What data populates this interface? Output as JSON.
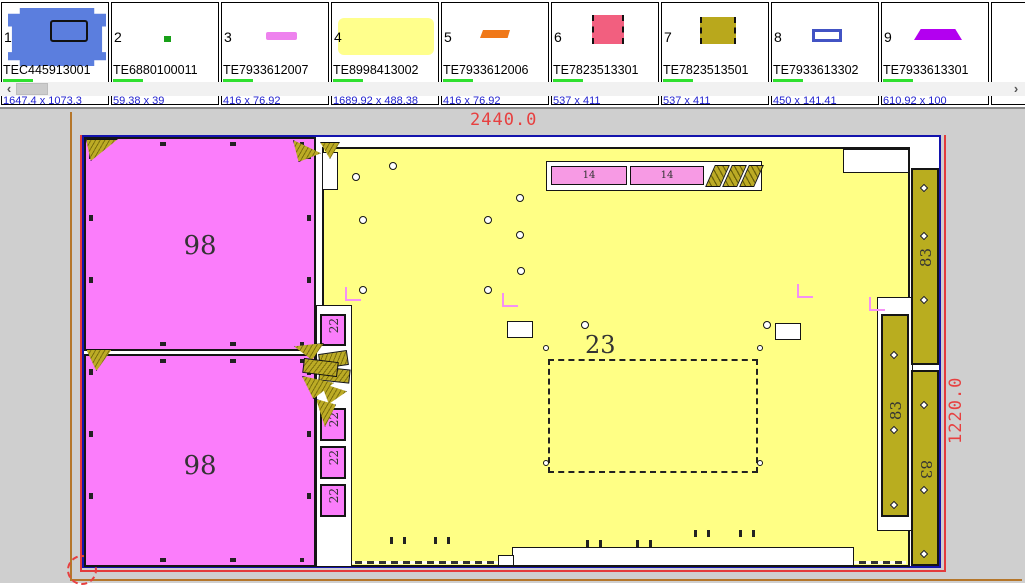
{
  "parts_strip": {
    "cells": [
      {
        "index": "1",
        "code": "TEC445913001",
        "dims": "1647.4 x 1073.3",
        "color": "#5b7ede",
        "shape": "panel-with-cutout"
      },
      {
        "index": "2",
        "code": "TE6880100011",
        "dims": "59.38 x 39",
        "color": "#18a018",
        "shape": "tiny-block"
      },
      {
        "index": "3",
        "code": "TE7933612007",
        "dims": "416 x 76.92",
        "color": "#ee82ee",
        "shape": "thin-bar"
      },
      {
        "index": "4",
        "code": "TE8998413002",
        "dims": "1689.92 x 488.38",
        "color": "#ffff8c",
        "shape": "large-panel"
      },
      {
        "index": "5",
        "code": "TE7933612006",
        "dims": "416 x 76.92",
        "color": "#f07818",
        "shape": "thin-bar"
      },
      {
        "index": "6",
        "code": "TE7823513301",
        "dims": "537 x 411",
        "color": "#f25f7f",
        "shape": "rect-dashed-sides"
      },
      {
        "index": "7",
        "code": "TE7823513501",
        "dims": "537 x 411",
        "color": "#b9a81c",
        "shape": "rect-dashed-sides"
      },
      {
        "index": "8",
        "code": "TE7933613302",
        "dims": "450 x 141.41",
        "color": "#4253c4",
        "shape": "flat-frame"
      },
      {
        "index": "9",
        "code": "TE7933613301",
        "dims": "610.92 x 100",
        "color": "#b300f0",
        "shape": "trapezoid"
      }
    ],
    "scrollbar": {
      "left_arrow": "‹",
      "right_arrow": "›"
    }
  },
  "canvas": {
    "sheet": {
      "width_label": "2440.0",
      "height_label": "1220.0"
    },
    "parts": {
      "panel_top": "98",
      "panel_bottom": "98",
      "back_panel": "23",
      "shelves": [
        "14",
        "14"
      ],
      "rails": [
        "22",
        "22",
        "22",
        "22"
      ],
      "strips": [
        "83",
        "83",
        "83"
      ]
    },
    "colors": {
      "sheet_border": "#1313ad",
      "dimension_red": "#e74040",
      "panel_magenta": "#fb7dfb",
      "back_yellow": "#ffff85",
      "strip_olive": "#b9ad1f",
      "frame_orange": "#b5762a",
      "badge_green": "#2ee02e"
    }
  }
}
